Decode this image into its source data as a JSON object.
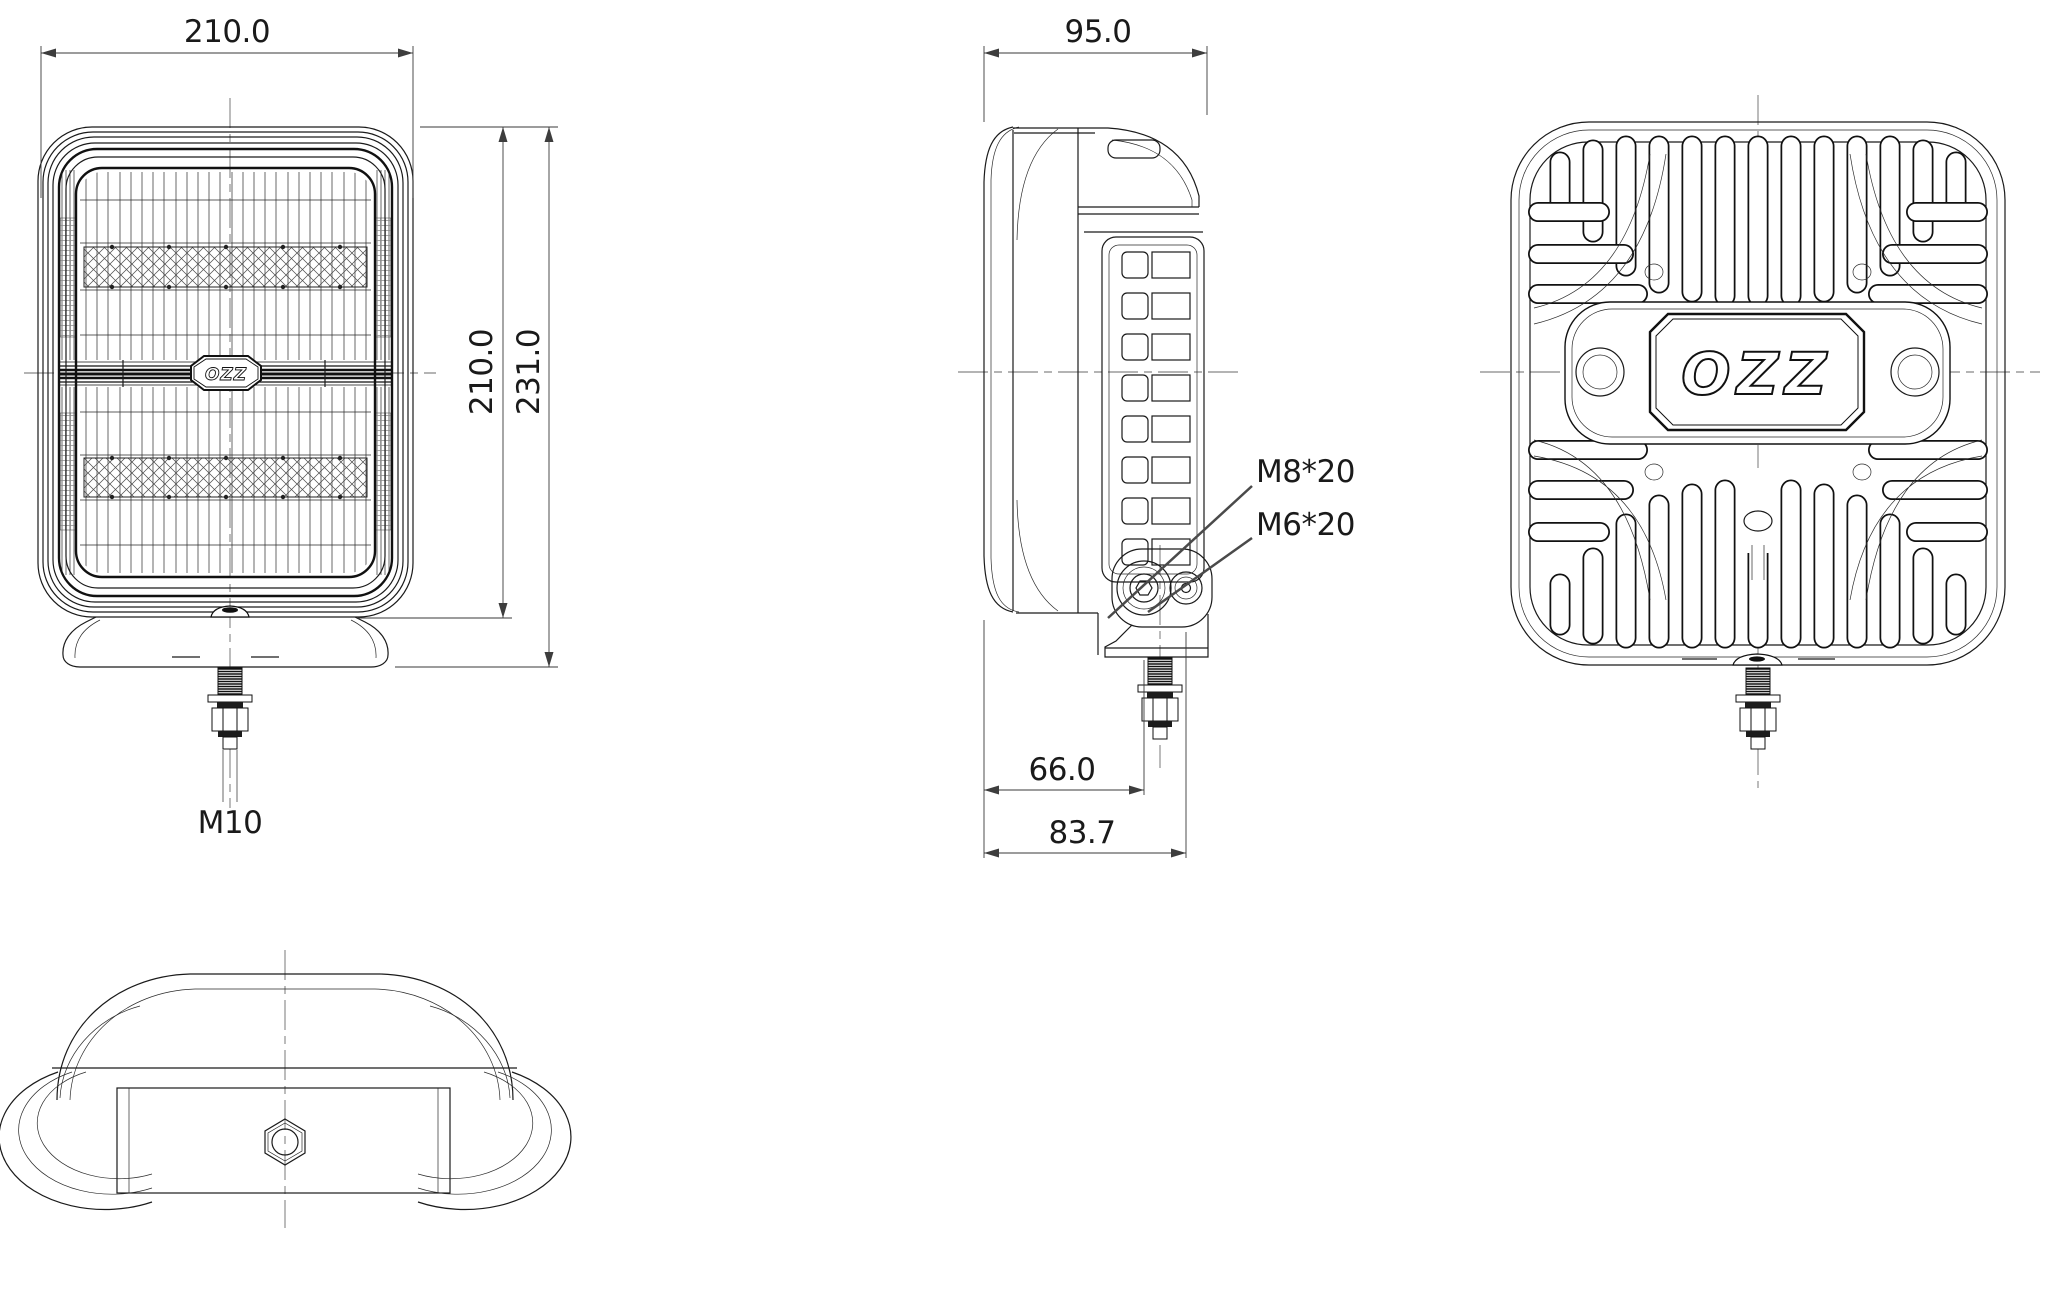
{
  "drawing": {
    "background": "#ffffff",
    "line_color": "#1a1a1a",
    "arrow_color": "#3d3d3d",
    "front_view": {
      "dim_width": "210.0",
      "dim_height_lens": "210.0",
      "dim_height_total": "231.0",
      "thread_label": "M10",
      "logo": "OZZ"
    },
    "side_view": {
      "dim_depth": "95.0",
      "callout_upper_bolt": "M8*20",
      "callout_lower_bolt": "M6*20",
      "dim_bolt_offset_1": "66.0",
      "dim_bolt_offset_2": "83.7"
    },
    "back_view": {
      "logo": "OZZ"
    }
  }
}
